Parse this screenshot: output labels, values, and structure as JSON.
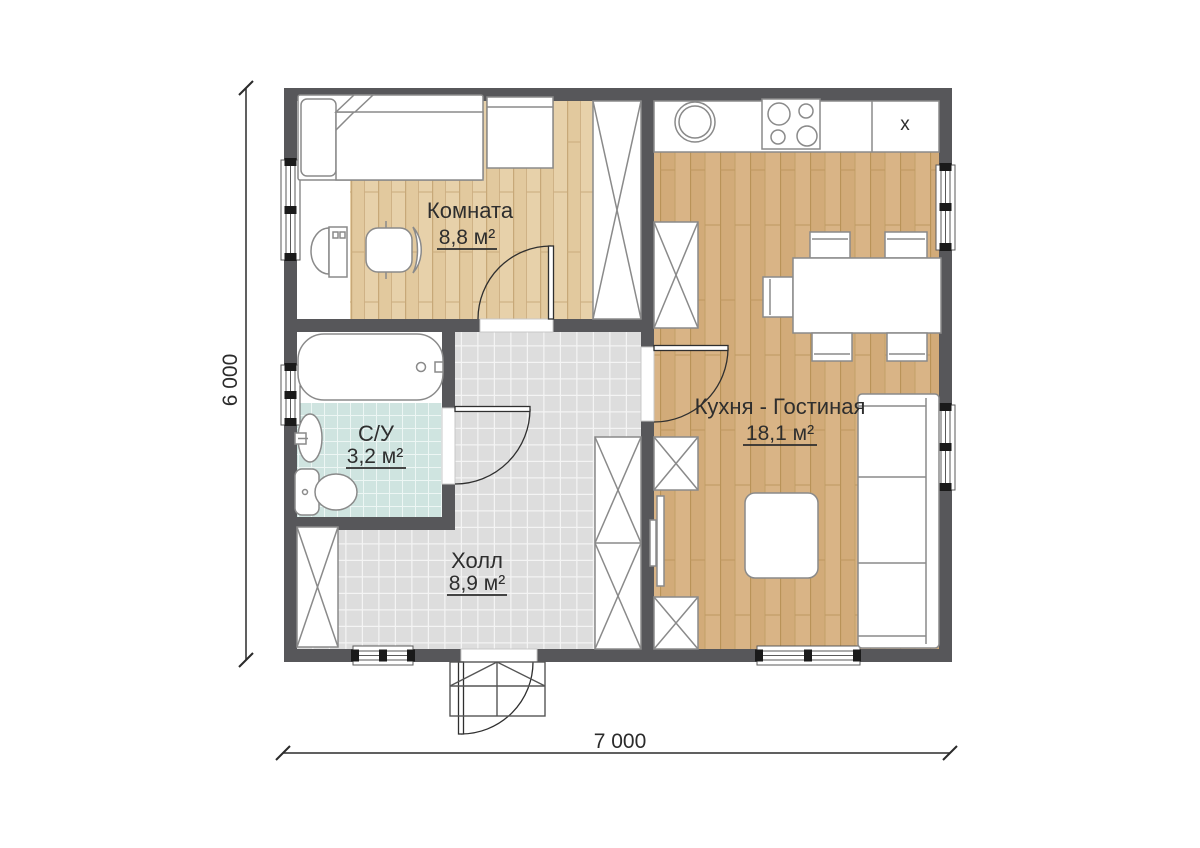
{
  "plan": {
    "rooms": {
      "bedroom": {
        "name": "Комната",
        "area": "8,8 м²"
      },
      "bathroom": {
        "name": "С/У",
        "area": "3,2 м²"
      },
      "hall": {
        "name": "Холл",
        "area": "8,9 м²"
      },
      "kitchen_living": {
        "name": "Кухня - Гостиная",
        "area": "18,1 м²"
      }
    },
    "dimensions": {
      "width": "7 000",
      "height": "6 000"
    },
    "annotations": {
      "counter_mark": "x"
    },
    "colors": {
      "wall": "#57575a",
      "bedroom_wood": "#e7d1aa",
      "kitchen_wood": "#d9b486",
      "bathroom_tile": "#cfe4e0",
      "hall_tile": "#dddddd"
    }
  }
}
